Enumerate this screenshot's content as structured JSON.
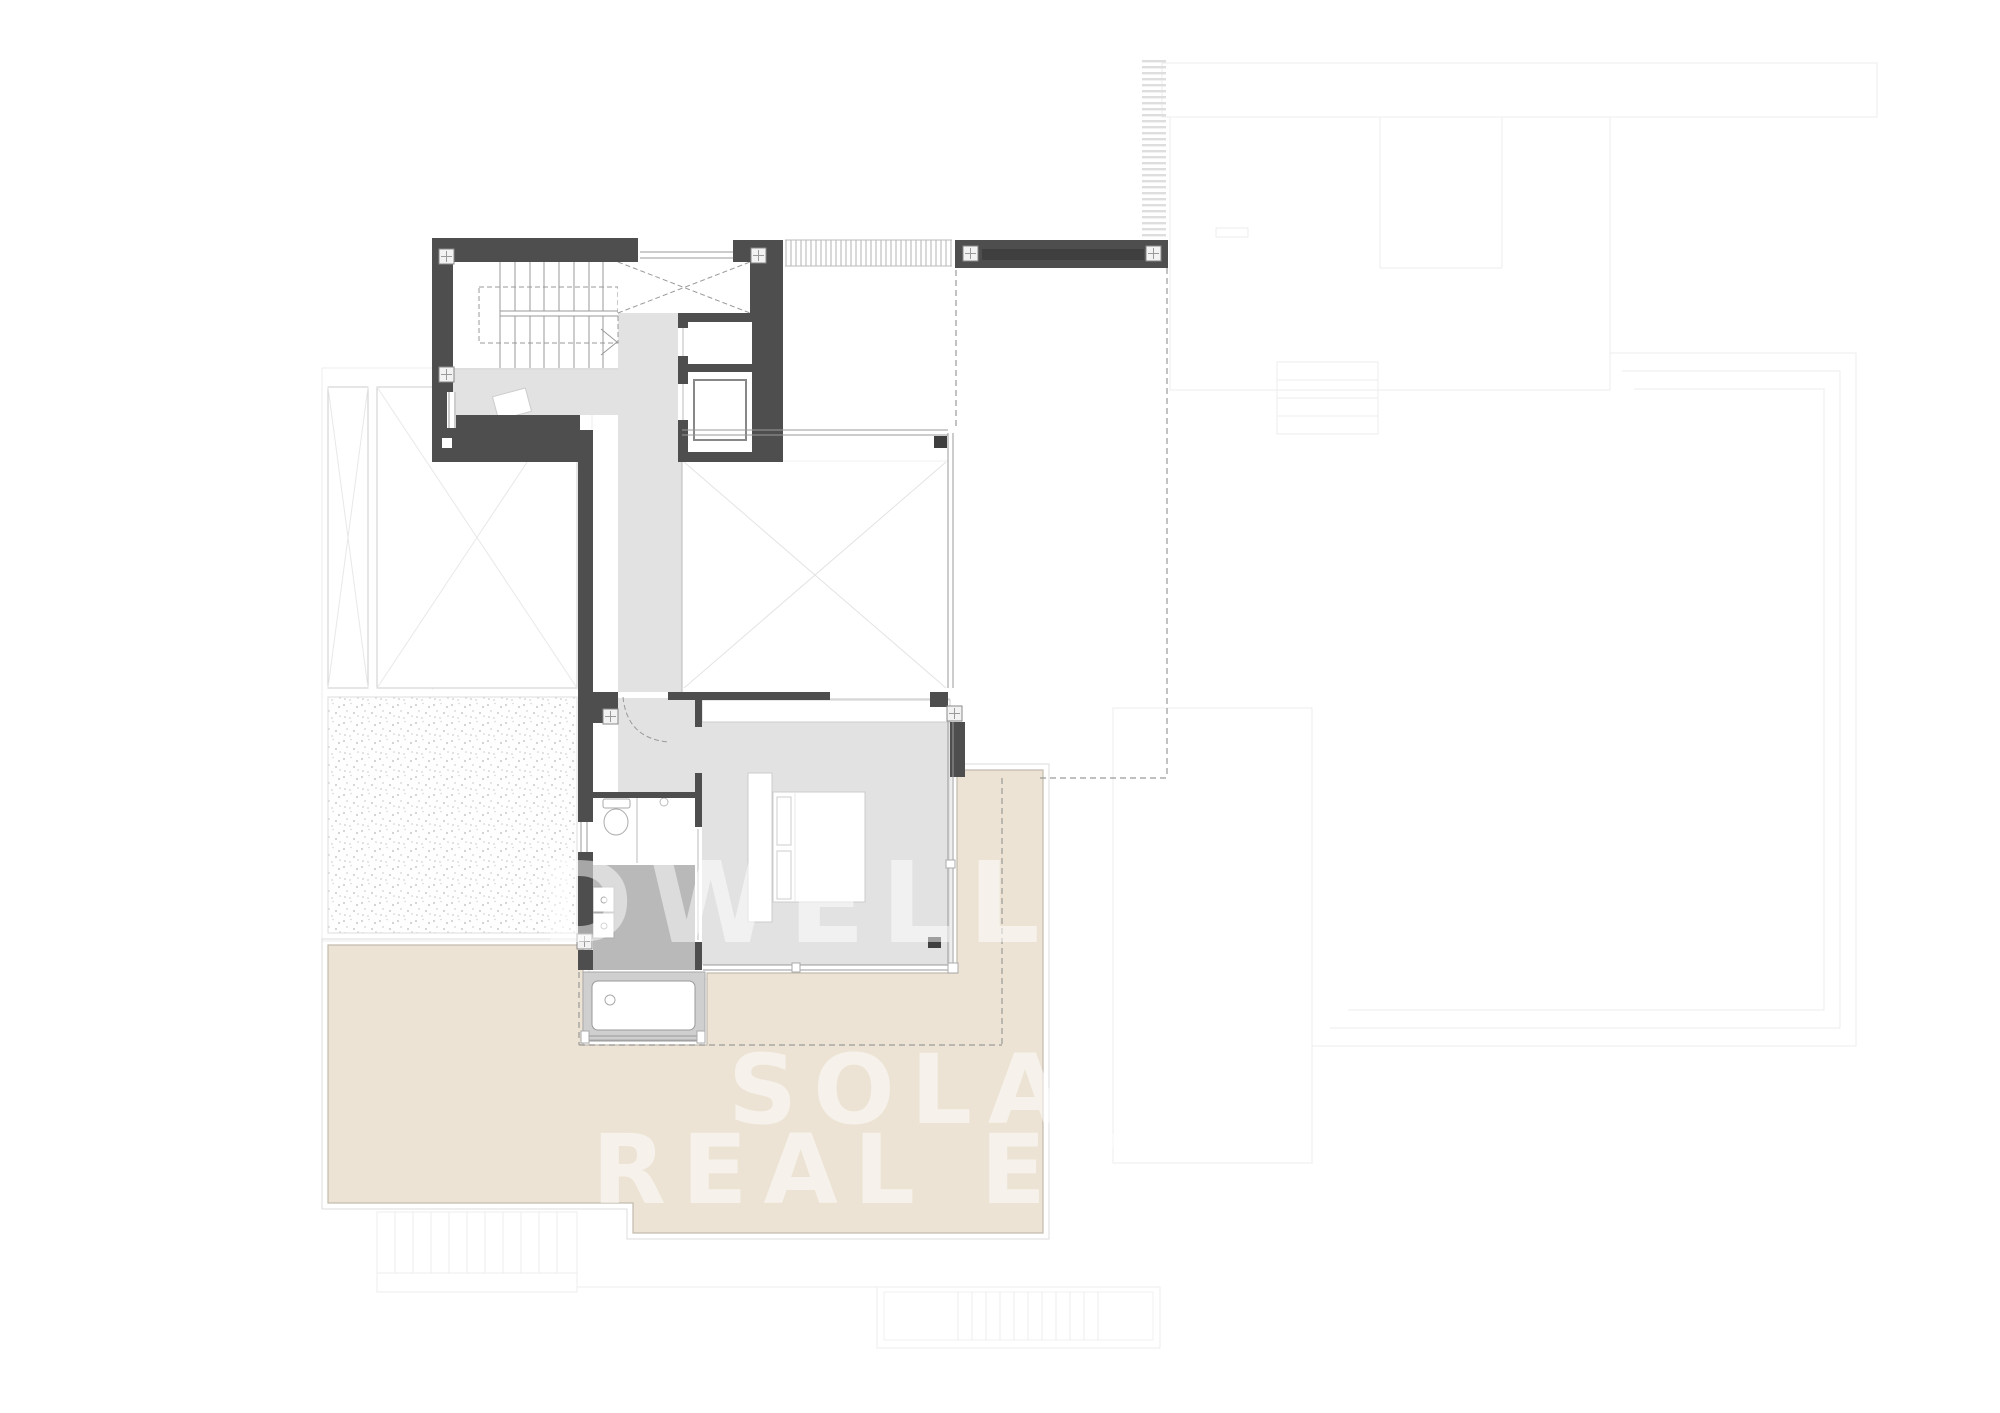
{
  "plan": {
    "kind": "architectural-floor-plan",
    "watermark": {
      "line1": "DWELL",
      "line2": "SOLA",
      "line3": "REAL ES"
    }
  },
  "colors": {
    "wall": "#4e4e4e",
    "wallDark": "#3f3f3f",
    "floor": "#e2e2e2",
    "bathFloor": "#b9b9b9",
    "tubSurround": "#cfcfcf",
    "terrace": "#ece3d4",
    "terraceEdge": "#c2bbae",
    "gravelDot": "#c9c9c9",
    "faint": "#ececec",
    "lineMid": "#999999",
    "dash": "#9a9a9a",
    "watermark": "rgba(255,255,255,0.5)"
  }
}
